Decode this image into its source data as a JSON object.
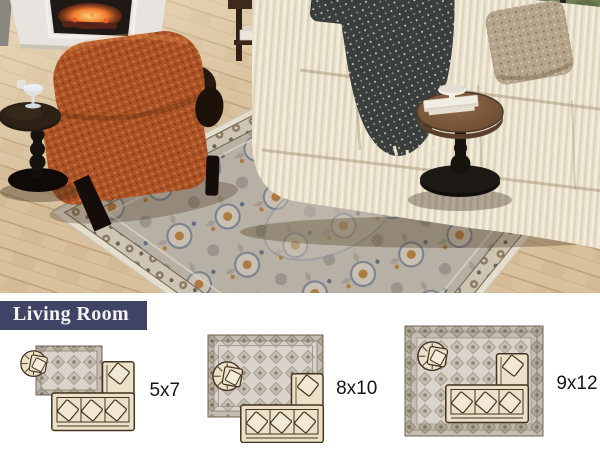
{
  "banner": {
    "label": "Living Room"
  },
  "diagrams": [
    {
      "id": "5x7",
      "label": "5x7"
    },
    {
      "id": "8x10",
      "label": "8x10"
    },
    {
      "id": "9x12",
      "label": "9x12"
    }
  ],
  "colors": {
    "banner_bg": "#3f4466",
    "banner_text": "#f5f3ee",
    "size_label_text": "#151515",
    "floor_wood": "#d8c09c",
    "rug_field": "#b7b0a5",
    "rug_edge_cream": "#e4ddcc",
    "armchair_rust": "#ab5226",
    "sofa_cream": "#ebe3cf",
    "throw_charcoal": "#3a3f3e",
    "table_wood_top": "#7a5a41",
    "table_black": "#12100c",
    "fire_orange": "#f07a2e",
    "diagram_outline": "#42331f",
    "diagram_fill": "#ece1c8"
  }
}
